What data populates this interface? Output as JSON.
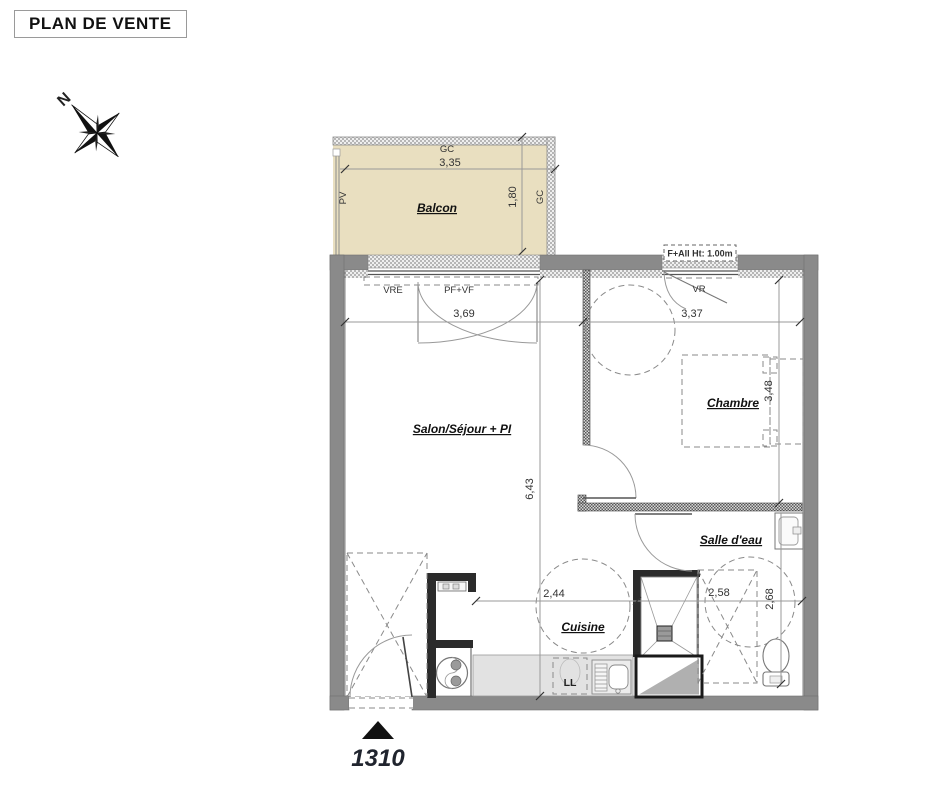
{
  "title": "PLAN DE VENTE",
  "compass": {
    "north": "N"
  },
  "balcony": {
    "label": "Balcon",
    "width": "3,35",
    "depth": "1,80",
    "rail_top": "GC",
    "rail_right": "GC",
    "screen_left": "PV"
  },
  "rooms": {
    "living": {
      "label": "Salon/Séjour + PI",
      "width": "3,69",
      "depth": "6,43"
    },
    "bedroom": {
      "label": "Chambre",
      "width": "3,37",
      "depth": "3,48"
    },
    "bathroom": {
      "label": "Salle d'eau",
      "width": "2,58",
      "depth": "2,68"
    },
    "kitchen": {
      "label": "Cuisine",
      "width": "2,44"
    }
  },
  "openings": {
    "roller_shutter": "VRE",
    "french_door": "PF+VF",
    "bedroom_shutter": "VR",
    "window_note": "F+All Ht: 1.00m"
  },
  "appliances": {
    "washer": "LL"
  },
  "unit_number": "1310",
  "colors": {
    "balcony_fill": "#e9dfc0",
    "wall_gray": "#8a8a8a",
    "counter_gray": "#e2e2e2"
  }
}
